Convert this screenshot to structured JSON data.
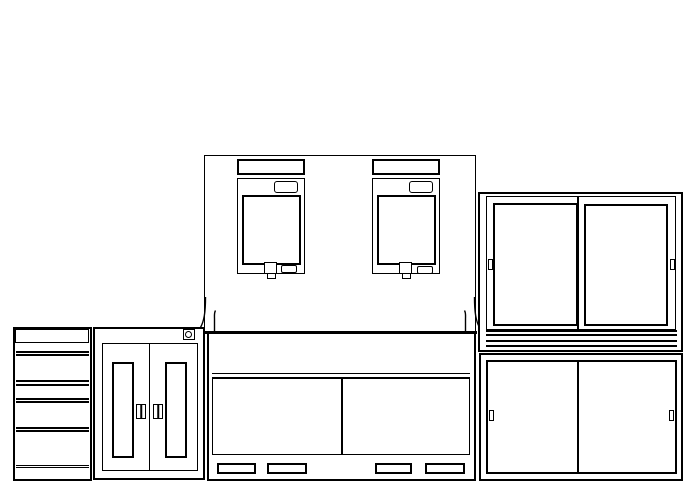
{
  "drawing": {
    "type": "cad-elevation-line-drawing",
    "background_color": "#ffffff",
    "line_color": "#000000",
    "parts": [
      {
        "name": "drawer-pedestal",
        "description": "tall unit of stacked drawers, far left"
      },
      {
        "name": "double-door-cabinet",
        "description": "hinged two-door cabinet with recessed panels, lock symbol top right"
      },
      {
        "name": "lock-symbol",
        "description": "small square with circle glyph"
      },
      {
        "name": "back-panel",
        "description": "large rear panel above countertop"
      },
      {
        "name": "equipment-module-left",
        "description": "wall module with header, control pad, window, knob and vent"
      },
      {
        "name": "equipment-module-right",
        "description": "wall module with header, control pad, window, knob and vent"
      },
      {
        "name": "countertop",
        "description": "thick worktop line across middle section"
      },
      {
        "name": "middle-base-cabinet",
        "description": "under-counter cabinet, two doors, four vent slots"
      },
      {
        "name": "sliding-door-upper-cabinet",
        "description": "right upper cabinet with two sliding doors and double bottom rails"
      },
      {
        "name": "sliding-door-lower-cabinet",
        "description": "right lower cabinet with two sliding doors"
      }
    ]
  }
}
